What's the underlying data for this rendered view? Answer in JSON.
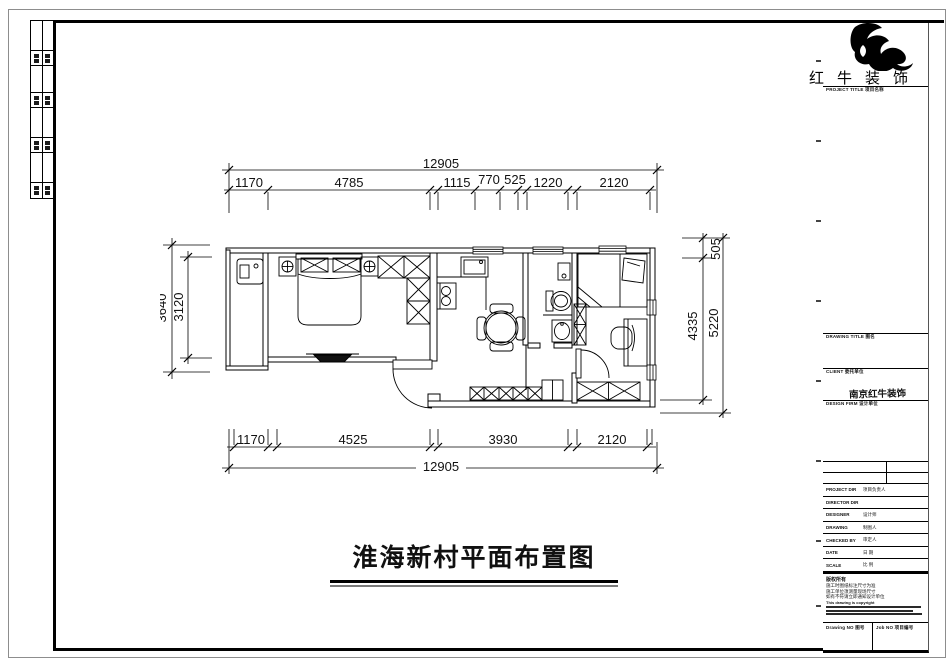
{
  "title_block": {
    "brand": "红牛装饰",
    "project_title_label": "PROJECT TITLE  项目名称",
    "drawing_title_label": "DRAWING TITLE  图名",
    "client_label": "CLIENT  委托单位",
    "client_value": "南京红牛装饰",
    "design_firm_label": "DESIGN FIRM  设计单位",
    "staff_rows": [
      {
        "en": "PROJECT DIR",
        "cn": "项目负责人"
      },
      {
        "en": "DIRECTOR DIR",
        "cn": ""
      },
      {
        "en": "DESIGNER",
        "cn": "设计师"
      },
      {
        "en": "DRAWING",
        "cn": "制图人"
      },
      {
        "en": "CHECKED BY",
        "cn": "审定人"
      },
      {
        "en": "DATE",
        "cn": "日 期"
      },
      {
        "en": "SCALE",
        "cn": "比 例"
      }
    ],
    "notes_title": "版权所有",
    "notes": [
      "施工时图纸标注尺寸为准",
      "施工单位须测量现场尺寸",
      "如有不符请立即通知设计单位",
      "This drawing is copyright"
    ],
    "drawing_no_label": "Drawing NO  图号",
    "job_no_label": "Job NO  项目编号"
  },
  "plan": {
    "title": "淮海新村平面布置图",
    "dims": {
      "top_total": "12905",
      "top": [
        "1170",
        "4785",
        "1115",
        "770",
        "525",
        "1220",
        "2120"
      ],
      "bottom": [
        "1170",
        "4525",
        "3930",
        "2120"
      ],
      "bottom_total": "12905",
      "left_outer": "3640",
      "left_inner": "3120",
      "right_top": "505",
      "right_inner": "4335",
      "right_outer": "5220"
    }
  }
}
